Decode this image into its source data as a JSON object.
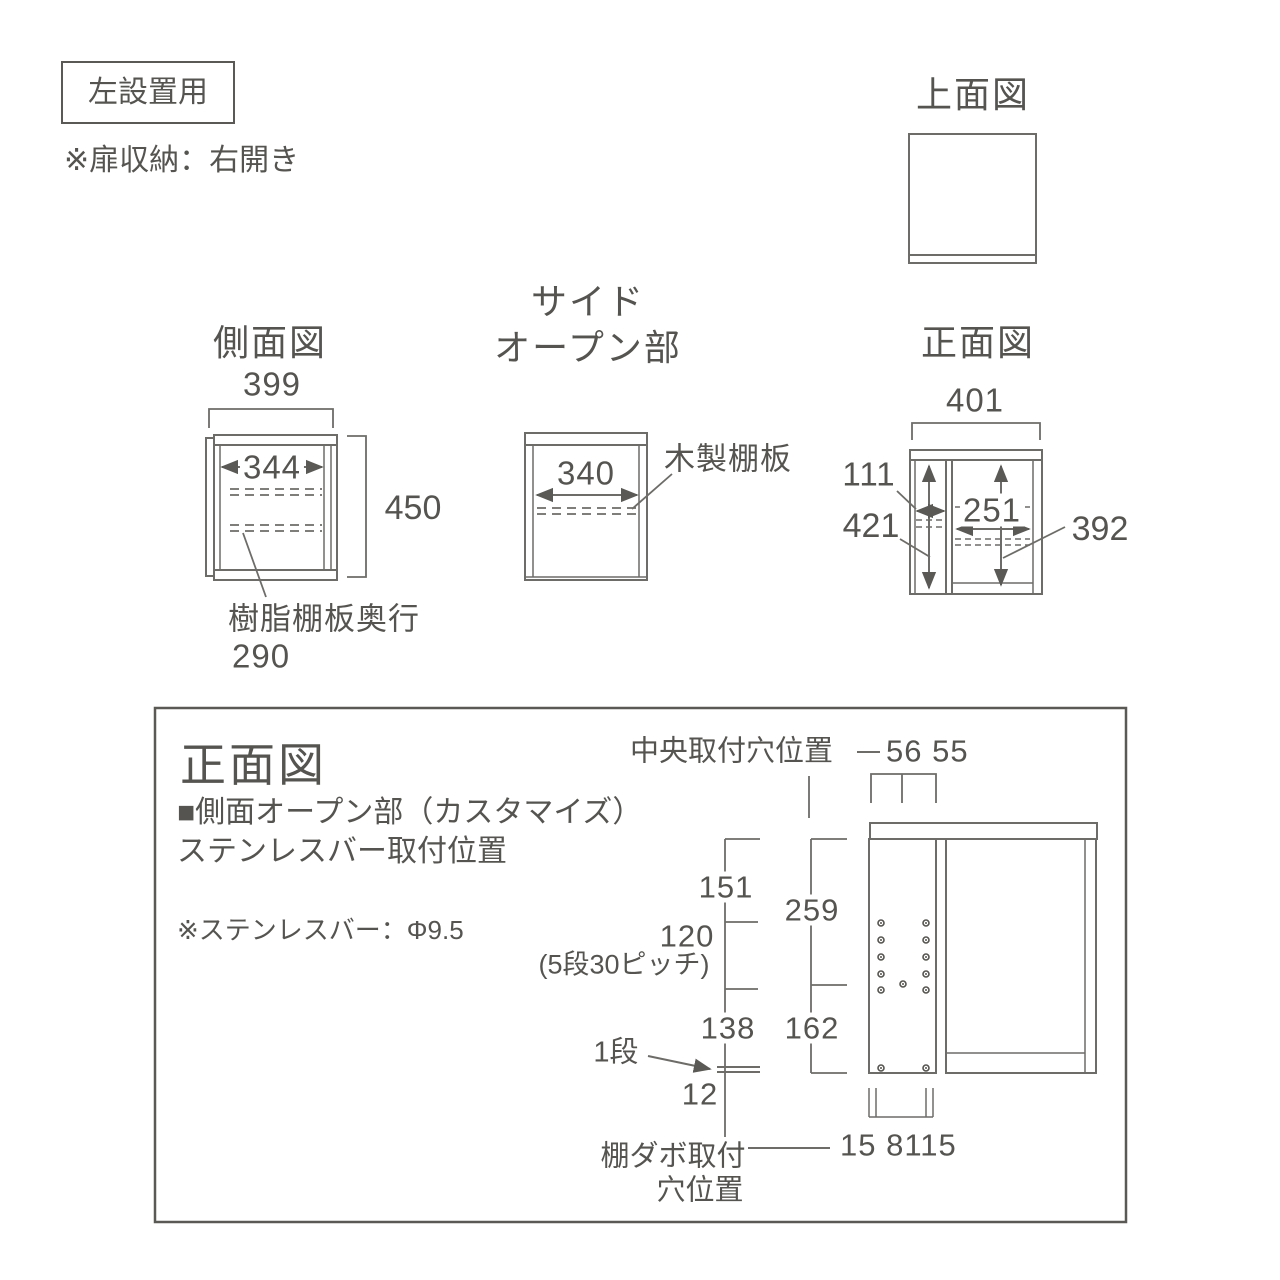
{
  "colors": {
    "line": "#6d6c68",
    "strong_line": "#5a5955",
    "text": "#555450",
    "bg": "#ffffff"
  },
  "top_left": {
    "badge": "左設置用",
    "note": "※扉収納：右開き"
  },
  "top_view": {
    "title": "上面図"
  },
  "side_view": {
    "title": "側面図",
    "width": "399",
    "inner_width": "344",
    "height": "450",
    "resin_shelf_label": "樹脂棚板奥行",
    "resin_shelf_depth": "290"
  },
  "side_open": {
    "title_line1": "サイド",
    "title_line2": "オープン部",
    "shelf_width": "340",
    "wood_shelf_label": "木製棚板"
  },
  "front_view": {
    "title": "正面図",
    "width": "401",
    "left_open_width": "111",
    "inner_height": "421",
    "right_inner_width": "251",
    "right_inner_height": "392"
  },
  "bottom_panel": {
    "title": "正面図",
    "subtitle_line1": "■側面オープン部（カスタマイズ）",
    "subtitle_line2": "ステンレスバー取付位置",
    "note": "※ステンレスバー：Φ9.5",
    "center_hole_label": "中央取付穴位置",
    "center_hole_dims": "56 55",
    "dim_151": "151",
    "dim_120": "120",
    "pitch_note": "(5段30ピッチ)",
    "dim_138": "138",
    "dim_12": "12",
    "dim_259": "259",
    "dim_162": "162",
    "one_shelf_label": "1段",
    "dabo_label_line1": "棚ダボ取付",
    "dabo_label_line2": "穴位置",
    "dabo_dims": "15 8115"
  }
}
